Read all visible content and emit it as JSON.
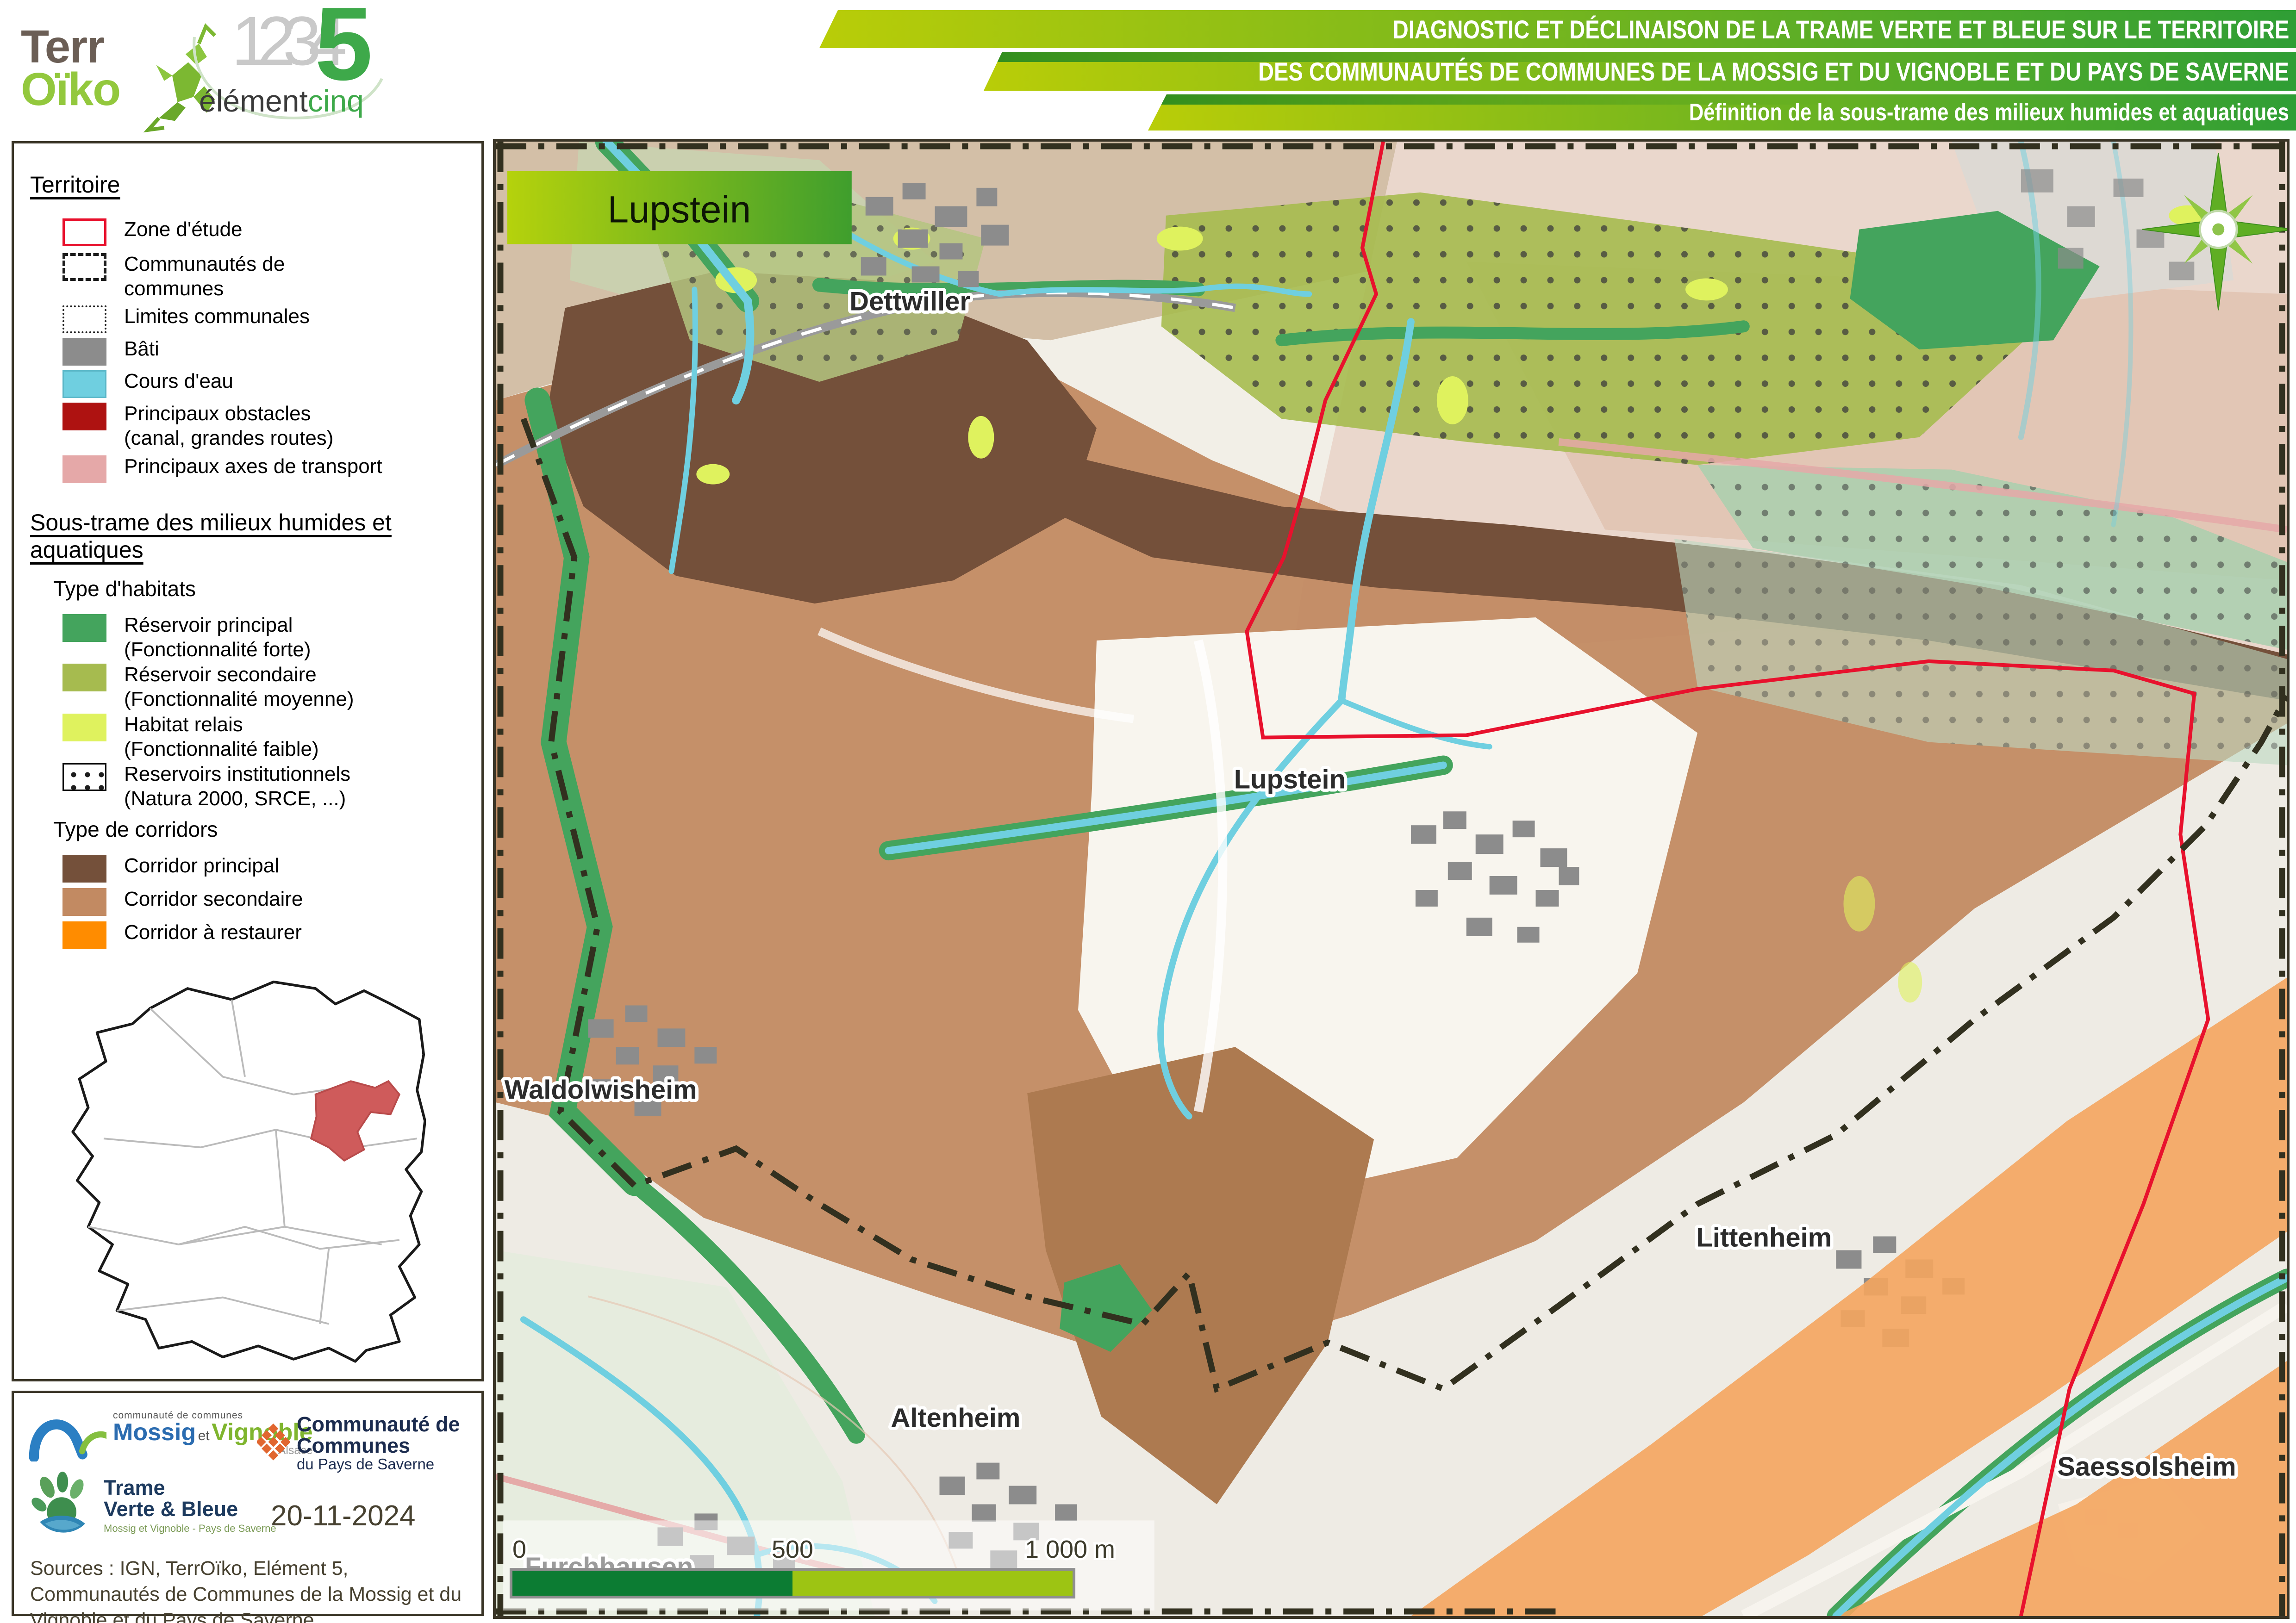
{
  "colors": {
    "frame_dark": "#3a3527",
    "banner_grad_left": "#b9cd08",
    "banner_grad_right": "#2f9e35",
    "zone_etude_red": "#e8112d",
    "bati_gray": "#8c8c8c",
    "cours_eau": "#6fcfe0",
    "obstacles_red": "#ae1211",
    "axes_pink": "#e5a8a8",
    "reservoir_principal": "#44a45d",
    "reservoir_secondaire": "#a6bb4f",
    "habitat_relais": "#dff25e",
    "corridor_principal": "#74503a",
    "corridor_secondaire": "#c28a62",
    "corridor_restaurer": "#ff8c00",
    "corridor_restaurer_map": "#f4a55e",
    "title_grad_left": "#b5d20c",
    "title_grad_right": "#3f9e2d"
  },
  "header": {
    "terroiko": {
      "line1": "Terr",
      "line2": "Oïko"
    },
    "element5": {
      "digits": "1234",
      "five": "5",
      "word1": "élément",
      "word2": "cinq"
    },
    "banners": [
      {
        "text": "DIAGNOSTIC ET DÉCLINAISON DE LA TRAME VERTE ET BLEUE SUR LE TERRITOIRE"
      },
      {
        "text": "DES COMMUNAUTÉS DE COMMUNES DE LA MOSSIG ET DU VIGNOBLE ET DU PAYS DE SAVERNE"
      },
      {
        "text": "Définition de la sous-trame des milieux humides et aquatiques"
      }
    ]
  },
  "legend": {
    "territoire_title": "Territoire",
    "territoire_items": [
      {
        "label": "Zone d'étude"
      },
      {
        "label": "Communautés de\ncommunes"
      },
      {
        "label": "Limites communales"
      },
      {
        "label": "Bâti"
      },
      {
        "label": "Cours d'eau"
      },
      {
        "label": "Principaux obstacles\n(canal, grandes routes)"
      },
      {
        "label": "Principaux axes de transport"
      }
    ],
    "soustrame_title": "Sous-trame des milieux humides et aquatiques",
    "habitats_title": "Type d'habitats",
    "habitats": [
      {
        "label": "Réservoir principal\n(Fonctionnalité forte)"
      },
      {
        "label": "Réservoir secondaire\n(Fonctionnalité moyenne)"
      },
      {
        "label": "Habitat relais\n(Fonctionnalité faible)"
      },
      {
        "label": "Reservoirs institutionnels\n(Natura 2000, SRCE, ...)"
      }
    ],
    "corridors_title": "Type de corridors",
    "corridors": [
      {
        "label": "Corridor principal"
      },
      {
        "label": "Corridor secondaire"
      },
      {
        "label": "Corridor à restaurer"
      }
    ]
  },
  "map": {
    "title_box": "Lupstein",
    "towns": {
      "dettwiller": "Dettwiller",
      "lupstein": "Lupstein",
      "waldolwisheim": "Waldolwisheim",
      "altenheim": "Altenheim",
      "littenheim": "Littenheim",
      "saessolsheim": "Saessolsheim",
      "furchhausen": "Furchhausen"
    },
    "scalebar": {
      "start": "0",
      "mid": "500",
      "end": "1 000 m"
    }
  },
  "footer": {
    "mossig_logo": {
      "top": "communauté de communes",
      "name1": "Mossig",
      "et": "et",
      "name2": "Vignoble",
      "region": "Alsace"
    },
    "saverne_logo": {
      "line1": "Communauté de Communes",
      "line2": "du Pays de Saverne"
    },
    "tvb_logo": {
      "line1": "Trame",
      "line2": "Verte & Bleue",
      "subtitle": "Mossig et Vignoble - Pays de Saverne"
    },
    "date": "20-11-2024",
    "sources": "Sources : IGN, TerrOïko, Elément 5, Communautés de Communes de la Mossig et du Vignoble et du Pays de Saverne"
  }
}
